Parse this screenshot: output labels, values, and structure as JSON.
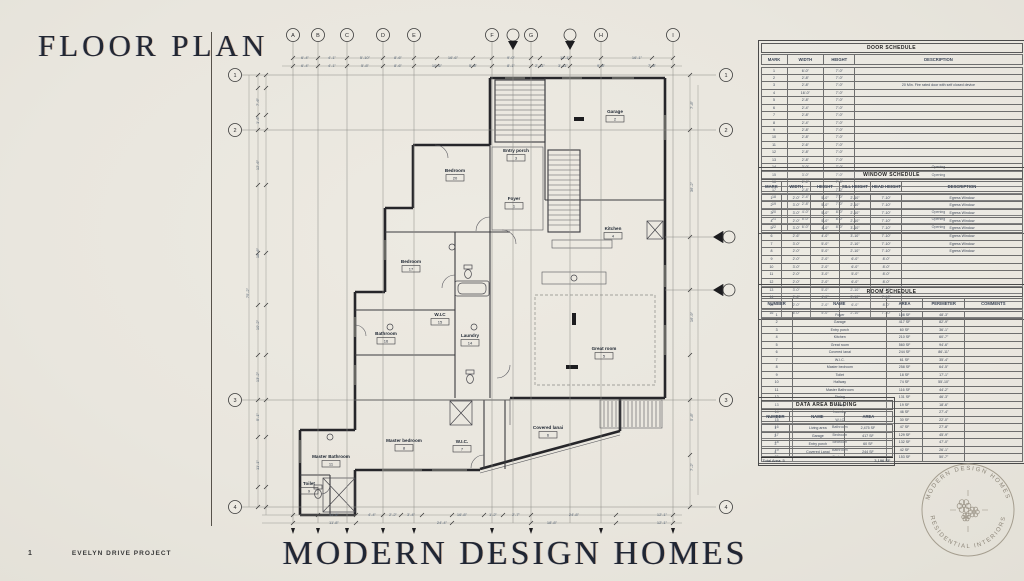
{
  "page": {
    "title": "FLOOR PLAN",
    "page_number": "1",
    "project_name": "EVELYN DRIVE PROJECT",
    "brand": "MODERN DESIGN HOMES"
  },
  "stamp": {
    "top_text": "MODERN DESIGN HOMES",
    "bottom_text": "RESIDENTIAL INTERIORS"
  },
  "colors": {
    "paper": "#e9e6de",
    "ink": "#26262a",
    "dim_text": "#5a6878",
    "title_ink": "#222733"
  },
  "door_schedule": {
    "title": "DOOR SCHEDULE",
    "columns": [
      "MARK",
      "WIDTH",
      "HEIGHT",
      "DESCRIPTION"
    ],
    "rows": [
      [
        "1",
        "6'-0\"",
        "7'-0\"",
        ""
      ],
      [
        "2",
        "2'-8\"",
        "7'-0\"",
        ""
      ],
      [
        "3",
        "2'-8\"",
        "7'-0\"",
        "20 Min. Fire rated door with self closed device"
      ],
      [
        "4",
        "16'-0\"",
        "7'-0\"",
        ""
      ],
      [
        "5",
        "2'-8\"",
        "7'-0\"",
        ""
      ],
      [
        "6",
        "2'-4\"",
        "7'-0\"",
        ""
      ],
      [
        "7",
        "2'-8\"",
        "7'-0\"",
        ""
      ],
      [
        "8",
        "2'-4\"",
        "7'-0\"",
        ""
      ],
      [
        "9",
        "2'-8\"",
        "7'-0\"",
        ""
      ],
      [
        "10",
        "2'-8\"",
        "7'-0\"",
        ""
      ],
      [
        "11",
        "2'-6\"",
        "7'-0\"",
        ""
      ],
      [
        "12",
        "2'-8\"",
        "7'-0\"",
        ""
      ],
      [
        "13",
        "2'-8\"",
        "7'-0\"",
        ""
      ],
      [
        "14",
        "3'-0\"",
        "7'-0\"",
        "Opening"
      ],
      [
        "15",
        "3'-0\"",
        "7'-0\"",
        "Opening"
      ],
      [
        "16",
        "2'-6\"",
        "7'-0\"",
        ""
      ],
      [
        "17",
        "2'-8\"",
        "7'-0\"",
        ""
      ],
      [
        "18",
        "2'-4\"",
        "7'-0\"",
        ""
      ],
      [
        "19",
        "2'-8\"",
        "7'-0\"",
        ""
      ],
      [
        "20",
        "4'-0\"",
        "8'-0\"",
        "Opening"
      ],
      [
        "21",
        "5'-0\"",
        "8'-0\"",
        "Opening"
      ],
      [
        "22",
        "6'-0\"",
        "8'-0\"",
        "Opening"
      ]
    ]
  },
  "window_schedule": {
    "title": "WINDOW SCHEDULE",
    "columns": [
      "MARK",
      "WIDTH",
      "HEIGHT",
      "SILL HEIGHT",
      "HEAD HEIGHT",
      "DESCRIPTION"
    ],
    "rows": [
      [
        "1",
        "2'-0\"",
        "5'-0\"",
        "2'-10\"",
        "7'-10\"",
        "Egress Window"
      ],
      [
        "2",
        "3'-0\"",
        "5'-0\"",
        "2'-10\"",
        "7'-10\"",
        "Egress Window"
      ],
      [
        "3",
        "3'-0\"",
        "5'-0\"",
        "2'-10\"",
        "7'-10\"",
        "Egress Window"
      ],
      [
        "4",
        "2'-0\"",
        "5'-0\"",
        "2'-10\"",
        "7'-10\"",
        "Egress Window"
      ],
      [
        "5",
        "3'-0\"",
        "4'-0\"",
        "3'-10\"",
        "7'-10\"",
        "Egress Window"
      ],
      [
        "6",
        "2'-6\"",
        "4'-0\"",
        "3'-10\"",
        "7'-10\"",
        "Egress Window"
      ],
      [
        "7",
        "3'-0\"",
        "5'-0\"",
        "2'-10\"",
        "7'-10\"",
        "Egress Window"
      ],
      [
        "8",
        "2'-0\"",
        "5'-0\"",
        "2'-10\"",
        "7'-10\"",
        "Egress Window"
      ],
      [
        "9",
        "2'-0\"",
        "2'-0\"",
        "6'-0\"",
        "8'-0\"",
        ""
      ],
      [
        "10",
        "3'-0\"",
        "2'-0\"",
        "6'-0\"",
        "8'-0\"",
        ""
      ],
      [
        "11",
        "2'-0\"",
        "3'-0\"",
        "5'-0\"",
        "8'-0\"",
        ""
      ],
      [
        "12",
        "2'-0\"",
        "2'-0\"",
        "6'-0\"",
        "8'-0\"",
        ""
      ],
      [
        "13",
        "3'-0\"",
        "5'-0\"",
        "2'-10\"",
        "7'-10\"",
        ""
      ],
      [
        "14",
        "2'-6\"",
        "4'-0\"",
        "3'-10\"",
        "7'-10\"",
        ""
      ],
      [
        "15",
        "2'-0\"",
        "2'-0\"",
        "6'-0\"",
        "8'-0\"",
        ""
      ],
      [
        "16",
        "6'-0\"",
        "5'-0\"",
        "2'-10\"",
        "7'-10\"",
        ""
      ]
    ]
  },
  "room_schedule": {
    "title": "ROOM SCHEDULE",
    "columns": [
      "NUMBER",
      "NAME",
      "AREA",
      "PERIMETER",
      "COMMENTS"
    ],
    "rows": [
      [
        "1",
        "Foyer",
        "108 SF",
        "48'-3\"",
        ""
      ],
      [
        "2",
        "Garage",
        "417 SF",
        "82'-9\"",
        ""
      ],
      [
        "3",
        "Entry porch",
        "60 SF",
        "36'-1\"",
        ""
      ],
      [
        "4",
        "Kitchen",
        "210 SF",
        "60'-7\"",
        ""
      ],
      [
        "5",
        "Great room",
        "560 SF",
        "94'-6\"",
        ""
      ],
      [
        "6",
        "Covered lanai",
        "244 SF",
        "86'-11\"",
        ""
      ],
      [
        "7",
        "W.I.C.",
        "61 SF",
        "35'-4\"",
        ""
      ],
      [
        "8",
        "Master bedroom",
        "258 SF",
        "64'-5\"",
        ""
      ],
      [
        "9",
        "Toilet",
        "18 SF",
        "17'-1\"",
        ""
      ],
      [
        "10",
        "Hallway",
        "74 SF",
        "55'-10\"",
        ""
      ],
      [
        "11",
        "Master Bathroom",
        "116 SF",
        "44'-2\"",
        ""
      ],
      [
        "12",
        "Dining",
        "131 SF",
        "46'-3\"",
        ""
      ],
      [
        "13",
        "Pantry",
        "19 SF",
        "18'-6\"",
        ""
      ],
      [
        "14",
        "Laundry",
        "46 SF",
        "27'-4\"",
        ""
      ],
      [
        "15",
        "W.I.C",
        "30 SF",
        "22'-0\"",
        ""
      ],
      [
        "16",
        "Bathroom",
        "47 SF",
        "27'-8\"",
        ""
      ],
      [
        "17",
        "Bedroom",
        "129 SF",
        "45'-9\"",
        ""
      ],
      [
        "18",
        "Bedroom",
        "132 SF",
        "47'-0\"",
        ""
      ],
      [
        "19",
        "Bathroom",
        "42 SF",
        "26'-1\"",
        ""
      ],
      [
        "20",
        "Bedroom",
        "153 SF",
        "50'-7\"",
        ""
      ]
    ]
  },
  "area_schedule": {
    "title": "DATA AREA BUILDING",
    "columns": [
      "NUMBER",
      "NAME",
      "AREA"
    ],
    "rows": [
      [
        "1",
        "Living area",
        "2,475 SF"
      ],
      [
        "2",
        "Garage",
        "417 SF"
      ],
      [
        "3",
        "Entry porch",
        "60 SF"
      ],
      [
        "4",
        "Covered Lanai",
        "244 SF"
      ]
    ],
    "total_label": "Total Area: 5",
    "total_value": "3,196 SF"
  },
  "plan": {
    "grid_top": [
      {
        "label": "A",
        "x": 71
      },
      {
        "label": "B",
        "x": 96
      },
      {
        "label": "C",
        "x": 125
      },
      {
        "label": "D",
        "x": 161
      },
      {
        "label": "E",
        "x": 192
      },
      {
        "label": "F",
        "x": 270
      },
      {
        "label": "G",
        "x": 309
      },
      {
        "label": "H",
        "x": 379
      },
      {
        "label": "I",
        "x": 451
      }
    ],
    "section_markers_x": [
      291,
      348
    ],
    "grid_side": [
      {
        "label": "1",
        "y": 50
      },
      {
        "label": "2",
        "y": 105
      },
      {
        "label": "3",
        "y": 375
      },
      {
        "label": "4",
        "y": 482
      }
    ],
    "elevation_markers_y": [
      212,
      265
    ],
    "rooms": [
      {
        "name": "Garage",
        "tag": "2",
        "x": 393,
        "y": 88
      },
      {
        "name": "Entry porch",
        "tag": "3",
        "x": 294,
        "y": 127
      },
      {
        "name": "Bedroom",
        "tag": "20",
        "x": 233,
        "y": 147
      },
      {
        "name": "Foyer",
        "tag": "1",
        "x": 292,
        "y": 175
      },
      {
        "name": "Kitchen",
        "tag": "4",
        "x": 391,
        "y": 205
      },
      {
        "name": "Bedroom",
        "tag": "17",
        "x": 189,
        "y": 238
      },
      {
        "name": "W.I.C",
        "tag": "15",
        "x": 218,
        "y": 291
      },
      {
        "name": "Bathroom",
        "tag": "16",
        "x": 164,
        "y": 310
      },
      {
        "name": "Laundry",
        "tag": "14",
        "x": 248,
        "y": 312
      },
      {
        "name": "Great room",
        "tag": "5",
        "x": 382,
        "y": 325
      },
      {
        "name": "Covered lanai",
        "tag": "6",
        "x": 326,
        "y": 404
      },
      {
        "name": "Master bedroom",
        "tag": "8",
        "x": 182,
        "y": 417
      },
      {
        "name": "W.I.C.",
        "tag": "7",
        "x": 240,
        "y": 418
      },
      {
        "name": "Master Bathroom",
        "tag": "11",
        "x": 109,
        "y": 433
      },
      {
        "name": "Toilet",
        "tag": "9",
        "x": 87,
        "y": 460
      }
    ],
    "dims": {
      "top1": {
        "y": 34,
        "items": [
          [
            "6'-4\"",
            83
          ],
          [
            "4'-1\"",
            110
          ],
          [
            "5'-10\"",
            143
          ],
          [
            "8'-6\"",
            176
          ],
          [
            "16'-6\"",
            231
          ],
          [
            "9'-0\"",
            289
          ],
          [
            "11'-1\"",
            343
          ],
          [
            "16'-1\"",
            415
          ]
        ]
      },
      "top2": {
        "y": 42,
        "items": [
          [
            "6'-4\"",
            83
          ],
          [
            "4'-1\"",
            110
          ],
          [
            "5'-8\"",
            143
          ],
          [
            "8'-6\"",
            176
          ],
          [
            "10'-6\"",
            215
          ],
          [
            "5'-8\"",
            251
          ],
          [
            "8'-1\"",
            289
          ],
          [
            "2'-11\"",
            318
          ],
          [
            "3'-11\"",
            341
          ],
          [
            "9'-8\"",
            379
          ],
          [
            "7'-8\"",
            430
          ]
        ]
      },
      "bot1": {
        "y": 491,
        "items": [
          [
            "11'-8\"",
            112
          ],
          [
            "4'-4\"",
            150
          ],
          [
            "2'-2\"",
            171
          ],
          [
            "3'-4\"",
            189
          ],
          [
            "16'-8\"",
            240
          ],
          [
            "1'-2\"",
            271
          ],
          [
            "2'-7\"",
            294
          ],
          [
            "24'-8\"",
            352
          ],
          [
            "12'-1\"",
            440
          ]
        ]
      },
      "bot2": {
        "y": 499,
        "items": [
          [
            "11'-8\"",
            112
          ],
          [
            "24'-4\"",
            220
          ],
          [
            "18'-8\"",
            330
          ],
          [
            "12'-1\"",
            440
          ]
        ]
      },
      "left1": {
        "x": 37,
        "items": [
          [
            "7'-6\"",
            77
          ],
          [
            "1'-6\"",
            95
          ],
          [
            "12'-6\"",
            140
          ],
          [
            "18'-6\"",
            228
          ],
          [
            "10'-2\"",
            300
          ],
          [
            "13'-2\"",
            352
          ],
          [
            "5'-1\"",
            392
          ],
          [
            "11'-1\"",
            440
          ]
        ]
      },
      "left2": {
        "x": 27,
        "items": [
          [
            "75'-2\"",
            268
          ]
        ]
      },
      "right1": {
        "x": 471,
        "items": [
          [
            "7'-8\"",
            80
          ],
          [
            "36'-2\"",
            162
          ],
          [
            "16'-9\"",
            292
          ],
          [
            "5'-8\"",
            392
          ],
          [
            "7'-2\"",
            442
          ]
        ]
      }
    }
  }
}
